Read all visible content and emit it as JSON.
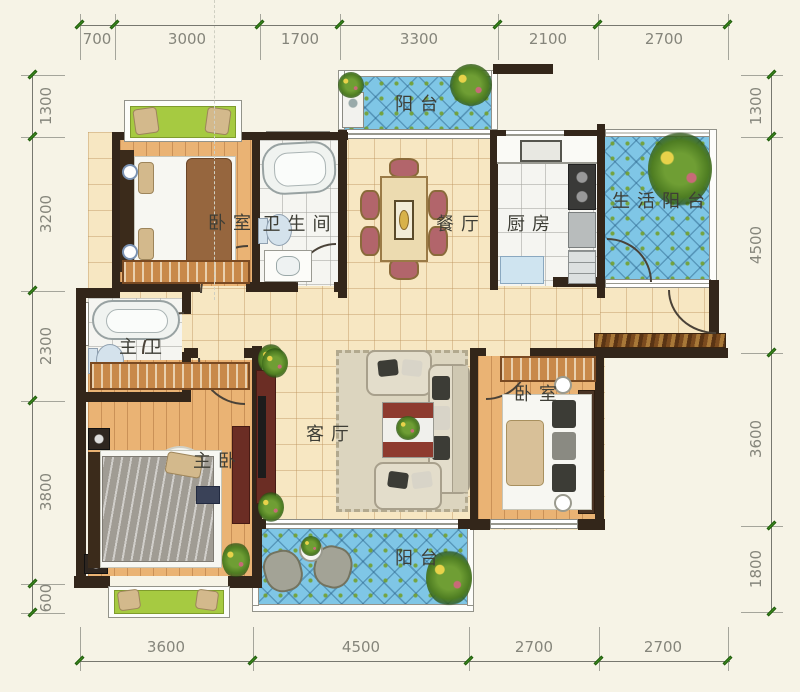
{
  "rooms": {
    "bedroom_top": {
      "label": "卧室"
    },
    "bathroom": {
      "label": "卫生间"
    },
    "balcony_top": {
      "label": "阳台"
    },
    "dining": {
      "label": "餐厅"
    },
    "kitchen": {
      "label": "厨房"
    },
    "service_balcony": {
      "label": "生活阳台"
    },
    "master_bath": {
      "label": "主卫"
    },
    "master_bedroom": {
      "label": "主卧"
    },
    "living": {
      "label": "客厅"
    },
    "bedroom_right": {
      "label": "卧室"
    },
    "balcony_bottom": {
      "label": "阳台"
    }
  },
  "dimensions": {
    "top": [
      "700",
      "3000",
      "1700",
      "3300",
      "2100",
      "2700"
    ],
    "bottom": [
      "3600",
      "4500",
      "2700",
      "2700"
    ],
    "left": [
      "1300",
      "3200",
      "2300",
      "3800",
      "600"
    ],
    "right": [
      "1300",
      "4500",
      "3600",
      "1800"
    ]
  },
  "colors": {
    "wall": "#33261a",
    "balcony_tile": "#7fc6e6",
    "wood_floor": "#eab374",
    "hall_tile": "#f7e7c2",
    "bay_window": "#a6ca41",
    "dimension_text": "#85857b",
    "tick_mark": "#3f8f1f"
  }
}
